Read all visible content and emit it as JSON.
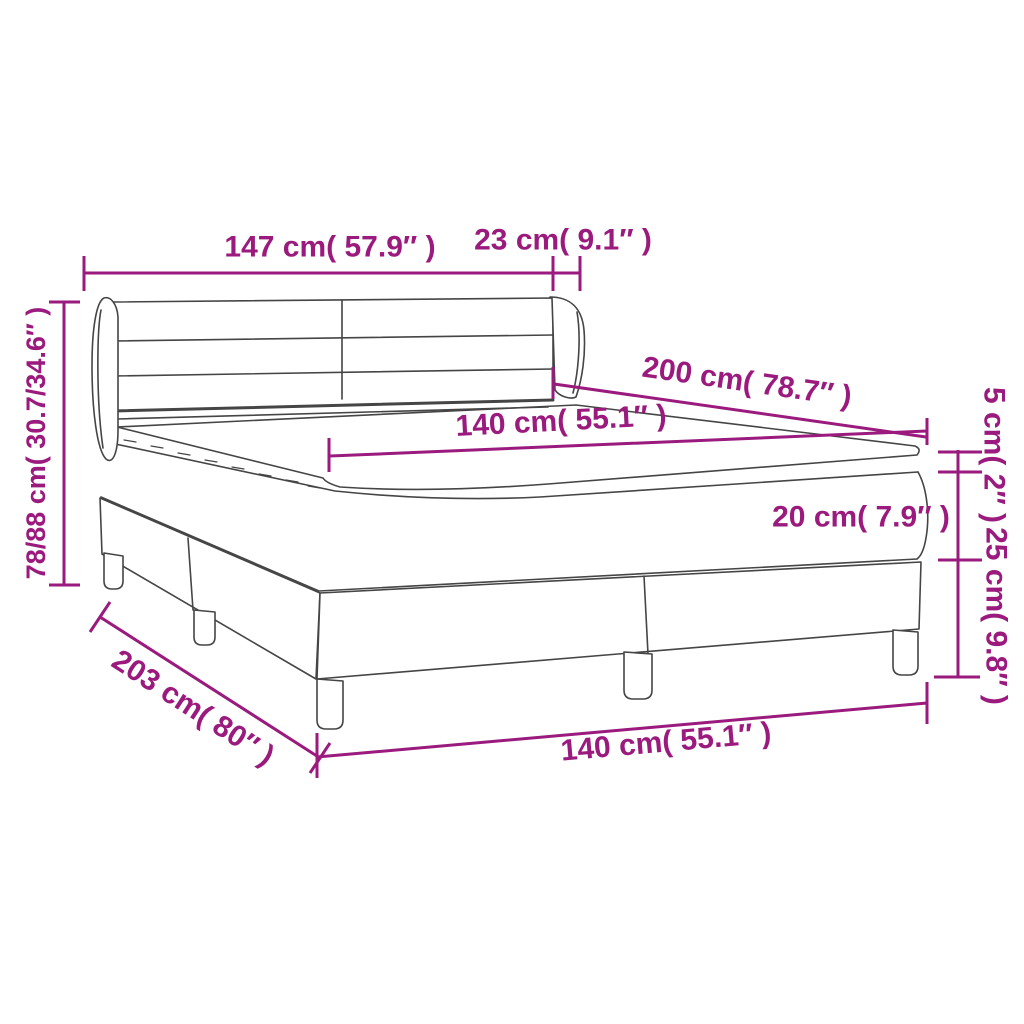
{
  "title": "Box spring bed with headboard and topper — dimension diagram",
  "colors": {
    "accent": "#9A1A7D",
    "line": "#454545",
    "background": "#FFFFFF"
  },
  "dimensions": {
    "headboard_width": "147 cm( 57.9″ )",
    "headboard_wing_depth": "23 cm( 9.1″ )",
    "overall_height": "78/88 cm( 30.7/34.6″ )",
    "bed_length": "200 cm( 78.7″ )",
    "mattress_width": "140 cm( 55.1″ )",
    "topper_height": "5 cm( 2″ )",
    "mattress_height": "20 cm( 7.9″ )",
    "base_height": "25 cm( 9.8″ )",
    "overall_length": "203 cm( 80″ )",
    "base_width": "140 cm( 55.1″ )"
  }
}
